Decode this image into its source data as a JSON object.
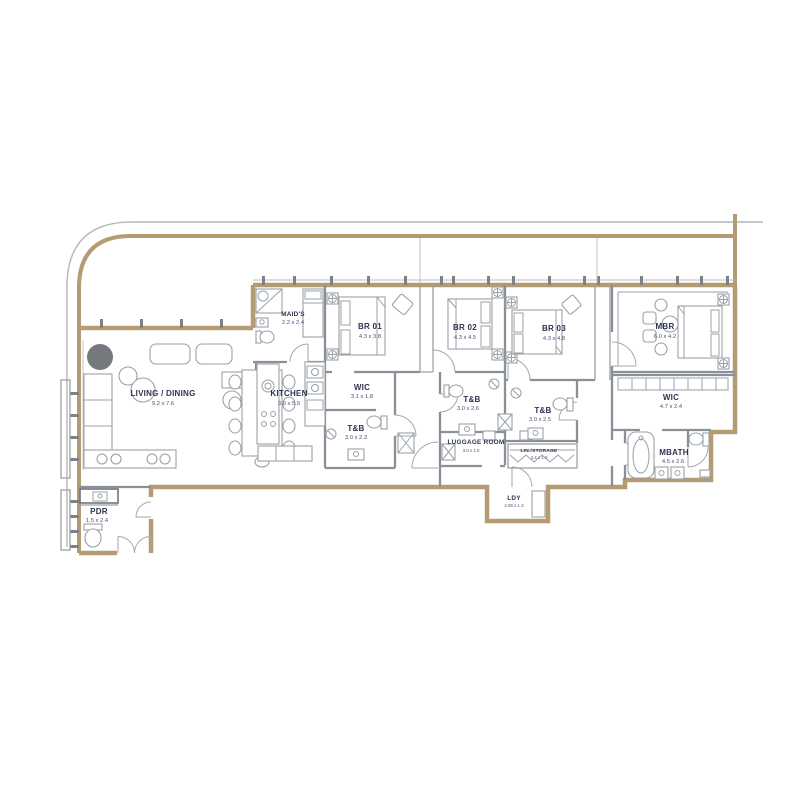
{
  "plan": {
    "type": "apartment-floor-plan",
    "colors": {
      "wall_accent": "#b49b72",
      "partition": "#8a9097",
      "furniture_line": "#9aa1a7",
      "label_text": "#2f3350",
      "dimension_text": "#584a72",
      "background": "#ffffff"
    },
    "rooms": [
      {
        "id": "living",
        "name": "LIVING / DINING",
        "dim": "9.2 x 7.6"
      },
      {
        "id": "kitchen",
        "name": "KITCHEN",
        "dim": "3.0 x 5.5"
      },
      {
        "id": "maids",
        "name": "MAID'S",
        "dim": "2.2 x 2.4"
      },
      {
        "id": "br01",
        "name": "BR 01",
        "dim": "4.3 x 3.8"
      },
      {
        "id": "wic1",
        "name": "WIC",
        "dim": "3.1 x 1.8"
      },
      {
        "id": "tb1",
        "name": "T&B",
        "dim": "3.0 x 2.3"
      },
      {
        "id": "br02",
        "name": "BR 02",
        "dim": "4.3 x 4.5"
      },
      {
        "id": "tb2",
        "name": "T&B",
        "dim": "3.0 x 2.6"
      },
      {
        "id": "br03",
        "name": "BR 03",
        "dim": "4.3 x 4.8"
      },
      {
        "id": "tb3",
        "name": "T&B",
        "dim": "3.0 x 2.5"
      },
      {
        "id": "luggage",
        "name": "LUGGAGE ROOM",
        "dim": "3.0 x 1.0"
      },
      {
        "id": "linen",
        "name": "LIN./STORAGE",
        "dim": "3.4 x 1.0"
      },
      {
        "id": "mbr",
        "name": "MBR",
        "dim": "6.0 x 4.2"
      },
      {
        "id": "wic2",
        "name": "WIC",
        "dim": "4.7 x 2.4"
      },
      {
        "id": "mbath",
        "name": "MBATH",
        "dim": "4.5 x 2.6"
      },
      {
        "id": "pdr",
        "name": "PDR",
        "dim": "1.5 x 2.4"
      },
      {
        "id": "ldy",
        "name": "LDY",
        "dim": "2.85 x 1.3"
      }
    ]
  }
}
